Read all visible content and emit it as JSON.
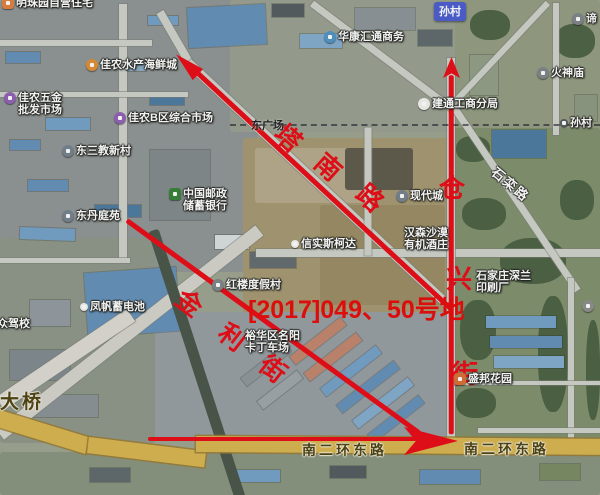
{
  "map": {
    "type": "satellite-map-with-annotations",
    "colors": {
      "annotation_red": "#e8000d",
      "parcel_red": "#e60000",
      "road_yellow": "#d7b24a",
      "badge_blue": "#4456cf",
      "poi_orange": "#e08a2e",
      "poi_purple": "#8e5bb5",
      "poi_green": "#2e7d32",
      "poi_gray": "#7a7f86",
      "poi_blue": "#4a90c4"
    },
    "town_badge": {
      "label": "孙村",
      "x": 434,
      "y": 2
    },
    "pois": [
      {
        "id": "mingzhuyuan-housing",
        "lines": [
          "明珠园自营住宅"
        ],
        "x": 2,
        "y": -3,
        "icon": "sq",
        "color": "#e07b39"
      },
      {
        "id": "jianong-seafood-city",
        "lines": [
          "佳农水产海鲜城"
        ],
        "x": 86,
        "y": 59,
        "icon": "rd",
        "color": "#e08a2e"
      },
      {
        "id": "jianong-hardware-market",
        "lines": [
          "佳农五金",
          "批发市场"
        ],
        "x": 4,
        "y": 92,
        "icon": "rd",
        "color": "#8e5bb5"
      },
      {
        "id": "jianong-b-market",
        "lines": [
          "佳农B区综合市场"
        ],
        "x": 114,
        "y": 112,
        "icon": "rd",
        "color": "#8e5bb5"
      },
      {
        "id": "dongsanjiao-village",
        "lines": [
          "东三教新村"
        ],
        "x": 62,
        "y": 145,
        "icon": "rd",
        "color": "#707c8c"
      },
      {
        "id": "dongdan-tingyuan",
        "lines": [
          "东丹庭苑"
        ],
        "x": 62,
        "y": 210,
        "icon": "rd",
        "color": "#707c8c"
      },
      {
        "id": "china-post-bank",
        "lines": [
          "中国邮政",
          "储蓄银行"
        ],
        "x": 169,
        "y": 188,
        "icon": "sq",
        "color": "#2e7d32"
      },
      {
        "id": "huakang-huitong",
        "lines": [
          "华康汇通商务"
        ],
        "x": 324,
        "y": 31,
        "icon": "rd",
        "color": "#4a90c4"
      },
      {
        "id": "huoshen-temple",
        "lines": [
          "火神庙"
        ],
        "x": 537,
        "y": 67,
        "icon": "rd",
        "color": "#7a7f86"
      },
      {
        "id": "di-temple-clipped",
        "lines": [
          "谛"
        ],
        "x": 572,
        "y": 13,
        "icon": "rd",
        "color": "#7a7f86"
      },
      {
        "id": "jiantong-aic-branch",
        "lines": [
          "建通工商分局"
        ],
        "x": 418,
        "y": 98,
        "icon": "rd",
        "color": "#f2f2f2"
      },
      {
        "id": "suncun-east",
        "lines": [
          "孙村"
        ],
        "x": 560,
        "y": 117,
        "icon": "dot",
        "color": "#50555b"
      },
      {
        "id": "xiandaicheng",
        "lines": [
          "现代城"
        ],
        "x": 396,
        "y": 190,
        "icon": "rd",
        "color": "#707c8c"
      },
      {
        "id": "hansen-winery",
        "lines": [
          "汉森沙漠",
          "有机酒庄"
        ],
        "x": 404,
        "y": 227,
        "icon": "none",
        "color": ""
      },
      {
        "id": "xinshi-skoda",
        "lines": [
          "信实斯柯达"
        ],
        "x": 291,
        "y": 238,
        "icon": "dot",
        "color": "#f2f2f2"
      },
      {
        "id": "honglou-resort",
        "lines": [
          "红楼度假村"
        ],
        "x": 212,
        "y": 279,
        "icon": "rd",
        "color": "#7a7f86"
      },
      {
        "id": "fengfan-battery",
        "lines": [
          "凤帆蓄电池"
        ],
        "x": 80,
        "y": 301,
        "icon": "dot",
        "color": "#f2f2f2"
      },
      {
        "id": "dazhong-driving-school",
        "lines": [
          "大众驾校"
        ],
        "x": -14,
        "y": 318,
        "icon": "none",
        "color": ""
      },
      {
        "id": "mingyang-karting",
        "lines": [
          "裕华区名阳",
          "卡丁车场"
        ],
        "x": 245,
        "y": 330,
        "icon": "none",
        "color": ""
      },
      {
        "id": "shenlan-printing",
        "lines": [
          "石家庄深兰",
          "印刷厂"
        ],
        "x": 476,
        "y": 270,
        "icon": "none",
        "color": ""
      },
      {
        "id": "shengbang-garden",
        "lines": [
          "盛邦花园"
        ],
        "x": 454,
        "y": 373,
        "icon": "sq",
        "color": "#d8692e"
      },
      {
        "id": "unlabeled-poi",
        "lines": [],
        "x": 582,
        "y": 300,
        "icon": "rd",
        "color": "#8a8a8a"
      }
    ],
    "dark_labels": [
      {
        "id": "east-plaza",
        "text": "东广场",
        "x": 251,
        "y": 117
      }
    ],
    "road_labels": [
      {
        "id": "shiluan-road",
        "text": "石栾路",
        "x": 500,
        "y": 162,
        "rot": 40,
        "size": 13,
        "style": "white"
      },
      {
        "id": "south-2nd-ring-east-1",
        "text": "南二环东路",
        "x": 302,
        "y": 440,
        "rot": 0,
        "size": 14,
        "style": "yellow"
      },
      {
        "id": "south-2nd-ring-east-2",
        "text": "南二环东路",
        "x": 464,
        "y": 439,
        "rot": 0,
        "size": 14,
        "style": "yellow"
      },
      {
        "id": "bridge",
        "text": "大桥",
        "x": 0,
        "y": 387,
        "rot": 0,
        "size": 19,
        "style": "yellow"
      }
    ],
    "annotations": {
      "parcel_text": {
        "text": "[2017]049、50号地",
        "x": 248,
        "y": 290
      },
      "streets": [
        {
          "name": "塔南路",
          "chars": [
            {
              "c": "塔",
              "x": 289,
              "y": 139,
              "rot": 42
            },
            {
              "c": "南",
              "x": 329,
              "y": 168,
              "rot": 42
            },
            {
              "c": "路",
              "x": 371,
              "y": 199,
              "rot": 42
            }
          ]
        },
        {
          "name": "金利街",
          "chars": [
            {
              "c": "金",
              "x": 190,
              "y": 304,
              "rot": 38
            },
            {
              "c": "利",
              "x": 233,
              "y": 338,
              "rot": 38
            },
            {
              "c": "街",
              "x": 274,
              "y": 370,
              "rot": 38
            }
          ]
        },
        {
          "name": "仓兴街",
          "chars": [
            {
              "c": "仓",
              "x": 453,
              "y": 189,
              "rot": 0
            },
            {
              "c": "兴",
              "x": 460,
              "y": 280,
              "rot": 0
            },
            {
              "c": "街",
              "x": 466,
              "y": 375,
              "rot": 0
            }
          ]
        }
      ],
      "arrows": [
        {
          "id": "tananlu-arrow",
          "from": [
            452,
            310
          ],
          "to": [
            190,
            66
          ],
          "head": "nw"
        },
        {
          "id": "jinlijie-arrow",
          "from": [
            127,
            220
          ],
          "to": [
            420,
            433
          ],
          "head": "none"
        },
        {
          "id": "cangxingjie-arrow",
          "from": [
            451,
            434
          ],
          "to": [
            451,
            75
          ],
          "head": "up"
        },
        {
          "id": "nanerhuan-arrow",
          "from": [
            148,
            439
          ],
          "to": [
            420,
            439
          ],
          "head": "big-right"
        }
      ]
    }
  }
}
